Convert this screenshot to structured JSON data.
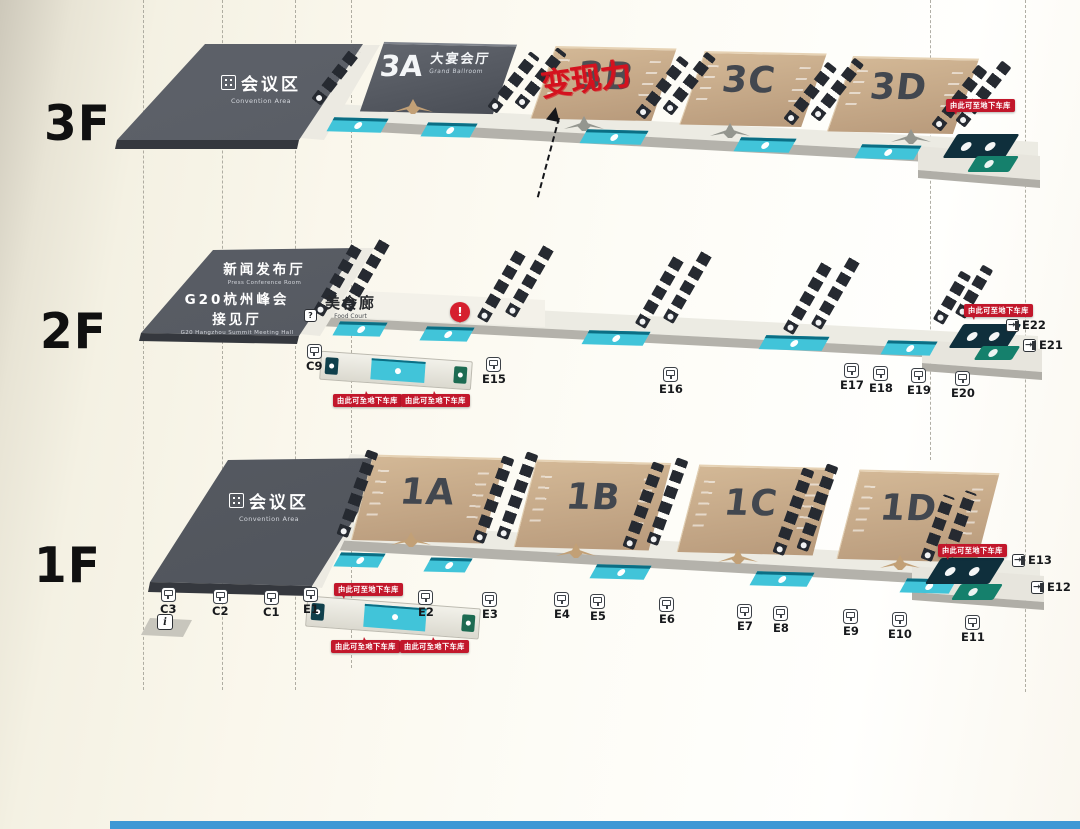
{
  "colors": {
    "accent-red": "#c2172b",
    "teal": "#41c4d9",
    "hall-tan": "#c2a384",
    "slab-gray": "#54585f",
    "bg-cream": "#f7f4e8",
    "blue-strip": "#3e98d5"
  },
  "floors": {
    "f3": "3F",
    "f2": "2F",
    "f1": "1F"
  },
  "f3": {
    "convention_zh": "会议区",
    "convention_en": "Convention Area",
    "hall_a_num": "3A",
    "hall_a_zh": "大宴会厅",
    "hall_a_en": "Grand Ballroom",
    "hall_b": "3B",
    "hall_c": "3C",
    "hall_d": "3D",
    "annotation": "变现力"
  },
  "f2": {
    "press_zh": "新闻发布厅",
    "press_en": "Press Conference Room",
    "g20_zh1": "G20杭州峰会",
    "g20_zh2": "接见厅",
    "g20_en": "G20 Hangzhou Summit Meeting Hall",
    "food_zh": "美食廊",
    "food_en": "Food Court",
    "question_mark": "?"
  },
  "f1": {
    "convention_zh": "会议区",
    "convention_en": "Convention Area",
    "hall_a": "1A",
    "hall_b": "1B",
    "hall_c": "1C",
    "hall_d": "1D",
    "info": "i"
  },
  "markers": [
    {
      "label": "C9",
      "x": 306,
      "y": 344,
      "type": "gate"
    },
    {
      "label": "E15",
      "x": 482,
      "y": 357,
      "type": "gate"
    },
    {
      "label": "E16",
      "x": 659,
      "y": 367,
      "type": "gate"
    },
    {
      "label": "E17",
      "x": 840,
      "y": 363,
      "type": "gate"
    },
    {
      "label": "E18",
      "x": 869,
      "y": 366,
      "type": "gate"
    },
    {
      "label": "E19",
      "x": 907,
      "y": 368,
      "type": "gate"
    },
    {
      "label": "E20",
      "x": 951,
      "y": 371,
      "type": "gate"
    },
    {
      "label": "E22",
      "x": 1006,
      "y": 319,
      "type": "exit"
    },
    {
      "label": "E21",
      "x": 1023,
      "y": 339,
      "type": "exit"
    },
    {
      "label": "C3",
      "x": 160,
      "y": 587,
      "type": "gate"
    },
    {
      "label": "C2",
      "x": 212,
      "y": 589,
      "type": "gate"
    },
    {
      "label": "C1",
      "x": 263,
      "y": 590,
      "type": "gate"
    },
    {
      "label": "E1",
      "x": 303,
      "y": 587,
      "type": "gate"
    },
    {
      "label": "E2",
      "x": 418,
      "y": 590,
      "type": "gate"
    },
    {
      "label": "E3",
      "x": 482,
      "y": 592,
      "type": "gate"
    },
    {
      "label": "E4",
      "x": 554,
      "y": 592,
      "type": "gate"
    },
    {
      "label": "E5",
      "x": 590,
      "y": 594,
      "type": "gate"
    },
    {
      "label": "E6",
      "x": 659,
      "y": 597,
      "type": "gate"
    },
    {
      "label": "E7",
      "x": 737,
      "y": 604,
      "type": "gate"
    },
    {
      "label": "E8",
      "x": 773,
      "y": 606,
      "type": "gate"
    },
    {
      "label": "E9",
      "x": 843,
      "y": 609,
      "type": "gate"
    },
    {
      "label": "E10",
      "x": 888,
      "y": 612,
      "type": "gate"
    },
    {
      "label": "E11",
      "x": 961,
      "y": 615,
      "type": "gate"
    },
    {
      "label": "E13",
      "x": 1012,
      "y": 554,
      "type": "exit"
    },
    {
      "label": "E12",
      "x": 1031,
      "y": 581,
      "type": "exit"
    }
  ],
  "badges": [
    {
      "label": "由此可至地下车库",
      "x": 946,
      "y": 99,
      "tail": "t-bl"
    },
    {
      "label": "由此可至地下车库",
      "x": 964,
      "y": 304,
      "tail": "t-bl"
    },
    {
      "label": "由此可至地下车库",
      "x": 333,
      "y": 394,
      "tail": "t-tc"
    },
    {
      "label": "由此可至地下车库",
      "x": 401,
      "y": 394,
      "tail": "t-tc"
    },
    {
      "label": "由此可至地下车库",
      "x": 938,
      "y": 544,
      "tail": "t-bl"
    },
    {
      "label": "由此可至地下车库",
      "x": 334,
      "y": 583,
      "tail": "t-bl"
    },
    {
      "label": "由此可至地下车库",
      "x": 331,
      "y": 640,
      "tail": "t-tc"
    },
    {
      "label": "由此可至地下车库",
      "x": 400,
      "y": 640,
      "tail": "t-tc"
    }
  ]
}
